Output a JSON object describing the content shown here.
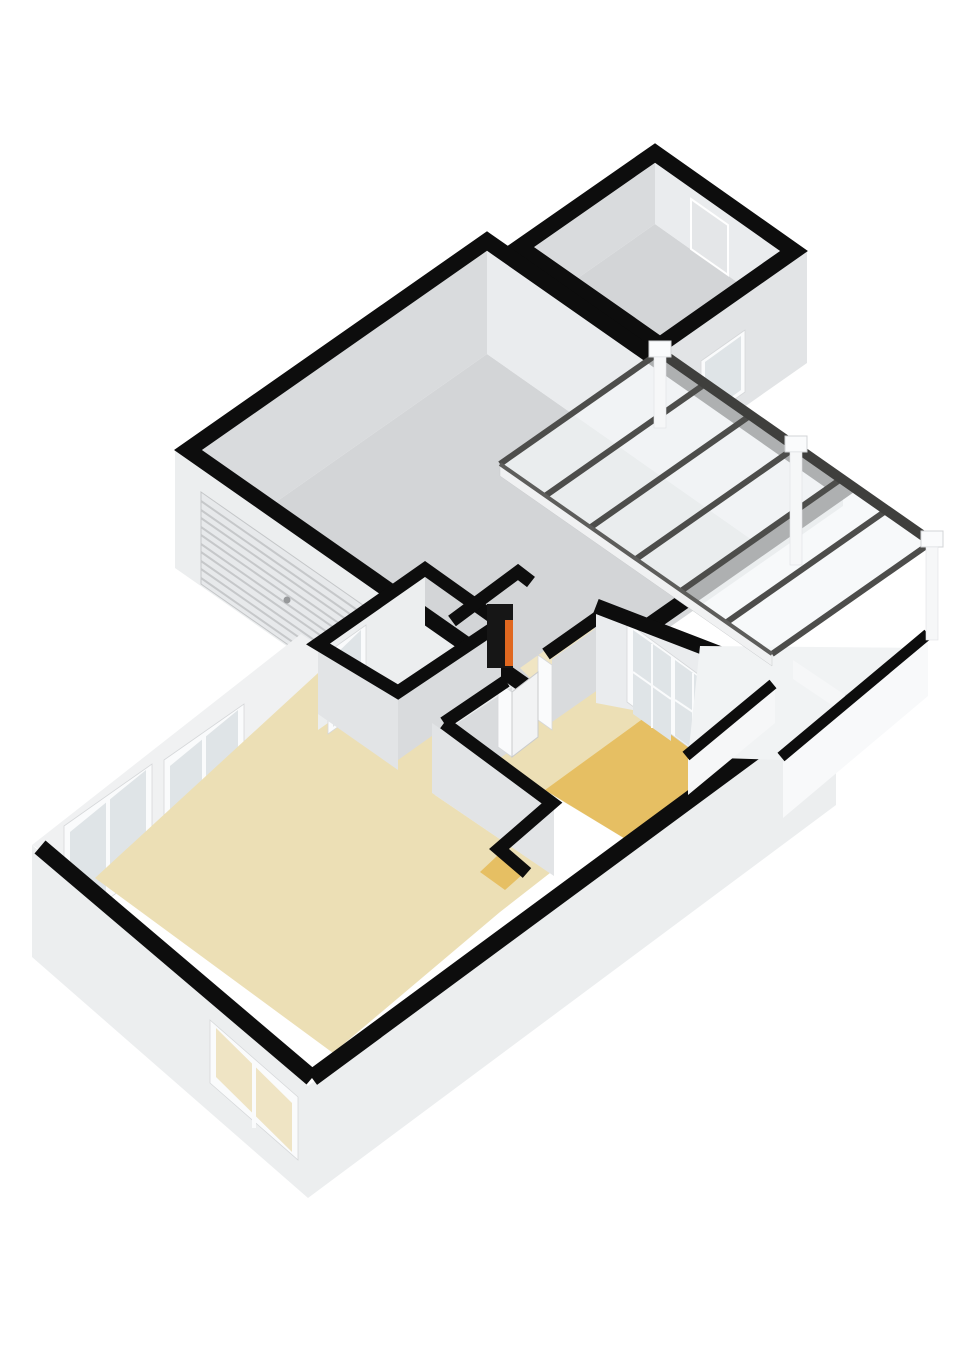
{
  "meta": {
    "title": "3D isometric floor plan rendering",
    "style": "white background, cut-away walls with black caps, no text labels"
  },
  "colors": {
    "background": "#ffffff",
    "wall_cap": "#0d0d0d",
    "wall_ext_light": "#eceeef",
    "wall_ext_mid": "#e2e4e6",
    "wall_ext_dark": "#d7d9db",
    "wall_inner_shadow": "#d9dbdd",
    "wall_inner_lit": "#eaecee",
    "wall_inner_bright": "#f0f1f2",
    "floor_gray": "#d3d5d7",
    "floor_beige": "#ecdfb5",
    "floor_beige_light": "#f0e5c3",
    "floor_gold": "#e6bf63",
    "glass_roof": "#f4f6f8",
    "beam_dark": "#3f3f3d",
    "rafter": "#4d4d4b",
    "beam_bottom": "#5d5d5b",
    "slat_line": "#c6c8ca",
    "glass_window": "#dfe4e7",
    "glass_window_warm": "#efe4c4",
    "frame_white": "#fafbfc",
    "door_leaf": "#f2f3f4",
    "door_ghost": "#e4e6e8",
    "garage_door_panel": "#e7e9eb",
    "handle_gray": "#97999b",
    "boiler_dark": "#161616",
    "boiler_orange": "#e06820",
    "post_white": "#f6f7f8",
    "deck_light": "#f1f3f4",
    "parapet_face": "#f8f9fa"
  },
  "scene": {
    "view": "axonometric from south-west, single storey",
    "rooms": [
      {
        "name": "garage",
        "floor": "gray",
        "features": [
          "slatted sectional garage door on front face",
          "door handle"
        ]
      },
      {
        "name": "storage-room",
        "floor": "gray",
        "features": [
          "exterior window on right face",
          "interior door outline"
        ]
      },
      {
        "name": "living-room",
        "floor": "beige",
        "features": [
          "two corner windows on upper-left wall",
          "window on lower-left wall"
        ]
      },
      {
        "name": "hall",
        "floor": "light beige",
        "features": [
          "interior door frames"
        ]
      },
      {
        "name": "bathroom",
        "floor": "beige",
        "features": [
          "window on inner-left face"
        ]
      },
      {
        "name": "bedroom",
        "floor": "beige with gold runner",
        "features": [
          "glazed french doors to conservatory",
          "interior door to hall"
        ]
      },
      {
        "name": "boiler-closet",
        "floor": "beige",
        "features": [
          "black heater unit with orange panel"
        ]
      },
      {
        "name": "conservatory",
        "floor": "white deck",
        "features": [
          "glass roof",
          "7 dark rafters",
          "dark ridge beam",
          "3 white post caps",
          "white posts",
          "low parapet walls with black caps"
        ]
      }
    ],
    "counts": {
      "windows": 5,
      "french_door_leaves": 2,
      "roof_rafters": 7,
      "roof_post_caps": 3,
      "garage_doors": 1
    }
  }
}
